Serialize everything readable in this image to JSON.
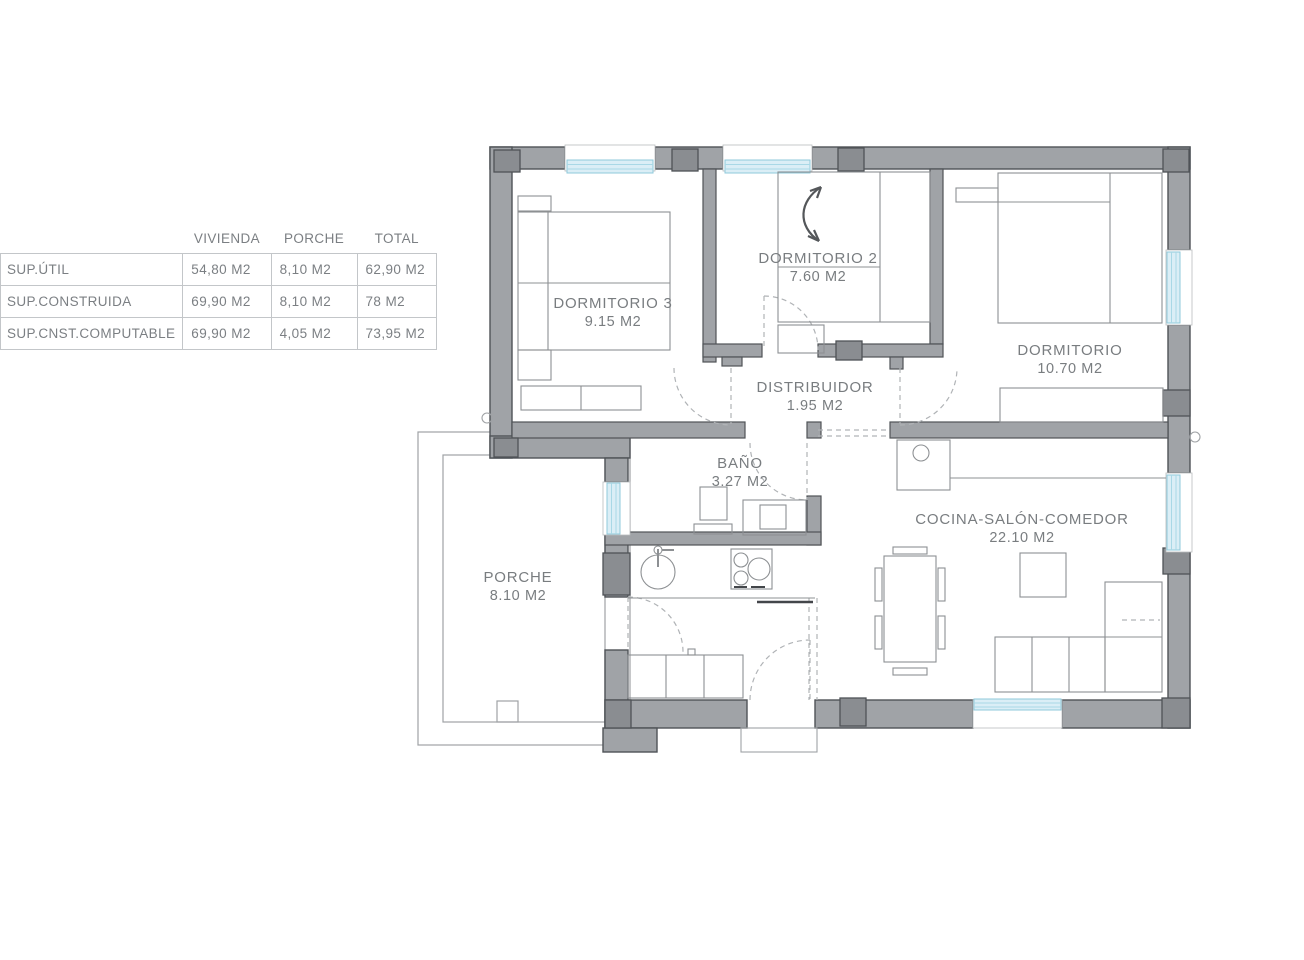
{
  "area_table": {
    "headers": [
      "VIVIENDA",
      "PORCHE",
      "TOTAL"
    ],
    "rows": [
      {
        "label": "SUP.ÚTIL",
        "vivienda": "54,80 M2",
        "porche": "8,10 M2",
        "total": "62,90 M2"
      },
      {
        "label": "SUP.CONSTRUIDA",
        "vivienda": "69,90 M2",
        "porche": "8,10 M2",
        "total": "78 M2"
      },
      {
        "label": "SUP.CNST.COMPUTABLE",
        "vivienda": "69,90 M2",
        "porche": "4,05 M2",
        "total": "73,95 M2"
      }
    ]
  },
  "floorplan": {
    "rooms": [
      {
        "name": "DORMITORIO 3",
        "area": "9.15 M2"
      },
      {
        "name": "DORMITORIO 2",
        "area": "7.60 M2"
      },
      {
        "name": "DORMITORIO",
        "area": "10.70 M2"
      },
      {
        "name": "DISTRIBUIDOR",
        "area": "1.95 M2"
      },
      {
        "name": "BAÑO",
        "area": "3.27 M2"
      },
      {
        "name": "COCINA-SALÓN-COMEDOR",
        "area": "22.10 M2"
      },
      {
        "name": "PORCHE",
        "area": "8.10 M2"
      }
    ],
    "colors": {
      "wall": "#a0a3a7",
      "wall_outline": "#4f5357",
      "pillar": "#8a8d91",
      "window": "#dbeef6",
      "window_line": "#8fc9db",
      "dashed_line": "#b0b3b6",
      "furniture_line": "#8d9093",
      "text": "#797d80"
    }
  }
}
